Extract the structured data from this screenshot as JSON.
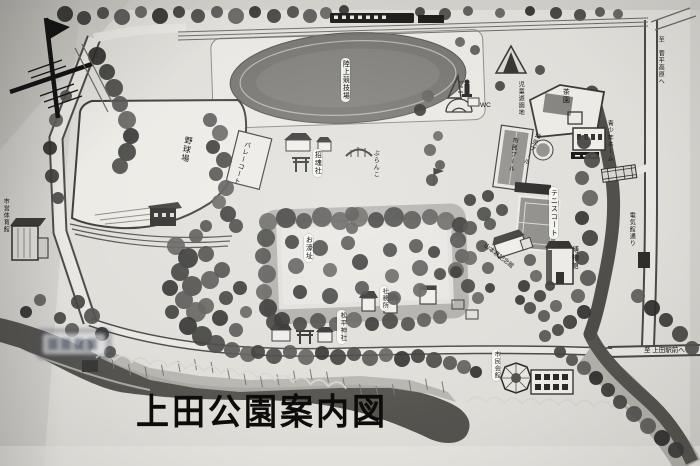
{
  "map": {
    "title": "上田公園案内図",
    "facilities": {
      "track": "陸上競技場",
      "baseball": "野球場",
      "gym": "市営体育館",
      "volleyball_court": "バレーコート",
      "shokonsha_shrine": "招魂社",
      "swing": "ぶらんこ",
      "moat_site": "お濠址",
      "shrine_office": "社務所",
      "matsudaira_shrine": "松平神社",
      "children_playground": "児童遊園地",
      "toilet": "WC",
      "tea_garden": "茶園",
      "citizen_pool": "市民プール",
      "infant_pool": "幼児プール",
      "youth_home": "青少年ホーム",
      "tennis_court": "テニスコート",
      "museum": "博物館",
      "yamamoto_kanae_hall": "山本鼎記念館",
      "civic_hall": "市民会館"
    },
    "directions": {
      "to_sugadaira": "至 菅平高原へ",
      "to_ueda_station": "至 上田駅前へ",
      "east_road": "電気館通り"
    },
    "palette": {
      "paper": "#e0ded9",
      "ink": "#1c1b19",
      "water": "#55534e",
      "moat": "#b0aea9",
      "field_dark": "#6e6c68"
    }
  }
}
